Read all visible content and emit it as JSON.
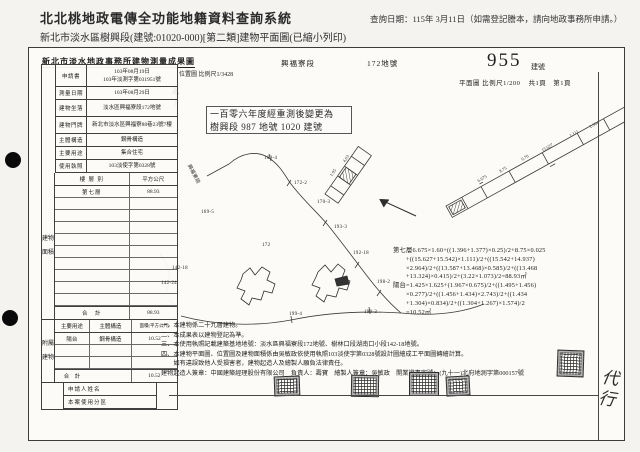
{
  "colors": {
    "paper": "#f3f2ef",
    "box_bg": "#fcfbf8",
    "line": "#3f3f3f",
    "text": "#1c1c1c"
  },
  "page": {
    "app_title": "北北桃地政電傳全功能地籍資料查詢系統",
    "query_date": "查詢日期：115年 3月11日（如需登記謄本，請向地政事務所申請。）",
    "subtitle": "新北市淡水區樹興段(建號:01020-000)[第二類]建物平面圖(已縮小列印)"
  },
  "form": {
    "title": "新北市淡水地政事務所建物測量成果圖",
    "section_name": "興福寮段",
    "parcel_no": "172地號",
    "building_no": "955",
    "building_no_suffix": "建號",
    "location_scale": "位置圖 比例尺1/3428",
    "plan_scale": "平面圖 比例尺1/200",
    "pages": "共1頁　第1頁",
    "callout": [
      "一百零六年度經重測後變更為",
      "樹興段 987 地號 1020 建號"
    ],
    "fields": [
      {
        "label": "申請書",
        "value": "103年08月19日",
        "value2": "103年淡測字第031951號"
      },
      {
        "label": "測量日期",
        "value": "103年08月29日"
      },
      {
        "label": "建物坐落",
        "value": "淡水區興福寮段172地號"
      },
      {
        "label": "建物門牌",
        "value": "新北市淡水區興福寮88巷23號7樓"
      },
      {
        "label": "主體構造",
        "value": "鋼骨構造"
      },
      {
        "label": "主要用途",
        "value": "集合住宅"
      },
      {
        "label": "使用執照",
        "value": "103淡使字第0328號"
      }
    ],
    "area": {
      "vertical_label": "建物面積",
      "h1": "樓 層 別",
      "h2": "平方公尺",
      "rows": [
        {
          "c1": "第七層",
          "c2": "88.93"
        }
      ],
      "total_label": "合　計",
      "total": "88.93"
    },
    "annex": {
      "vertical_label": "附屬建物",
      "h1": "主要用途",
      "h2": "主體構造",
      "h3": "面積(平方公尺)",
      "rows": [
        {
          "c1": "陽台",
          "c2": "鋼骨構造",
          "c3": "10.52"
        }
      ],
      "total_label": "合　計",
      "total": "10.52"
    },
    "bottom": [
      "申請人姓名",
      "本案使用分區"
    ],
    "formula_lines": [
      "第七層6.675×1.60+((1.396+1.377)×0.25)/2+8.75×0.025",
      "　　+((15.627+15.542)×1.111)/2+((15.542+14.937)",
      "　　×2.964)/2+((13.587+13.468)×0.585)/2+((13.468",
      "　　+13.324)×0.415)/2+(3.22×1.073)/2=88.93㎡",
      "陽台=1.425×1.625+(1.967×0.675)/2+((1.495+1.456)",
      "　　×0.277)/2+((1.456+1.434)×2.743)/2+((1.434",
      "　　+1.304)×0.834)/2+((1.304+1.267)×1.574)/2",
      "　　=10.52㎡"
    ],
    "notes": [
      "一、本建物係二十九層建物。",
      "二、本成果表以建物登記為準。",
      "三、本使用執照記載建築基地地號：淡水區興福寮段172地號、樹林口段湖南口小段142-18地號。",
      "四、本建物平面圖、位置圖及建物面積係由吳敏政依使用執照103淡使字第0328號設計圖繪成工平面圖轉繪計算。",
      "　　如有違誤致他人受損害者，建物起造人及繪製人願負法律責任。",
      "建物起造人簽章：中國建築經理股份有限公司　負責人：壽寶　繪製人簽章：吳敏政　開業證書字號：(九十一)北府地測字第000157號"
    ],
    "signature": "代行"
  },
  "map": {
    "parcels": [
      {
        "label": "169-4"
      },
      {
        "label": "172-2"
      },
      {
        "label": "170-3"
      },
      {
        "label": "193-3"
      },
      {
        "label": "192-18"
      },
      {
        "label": "198-2"
      },
      {
        "label": "172"
      },
      {
        "label": "142-18"
      },
      {
        "label": "142-24"
      },
      {
        "label": "199-4"
      },
      {
        "label": "199-3"
      },
      {
        "label": "169-5"
      },
      {
        "label": "興福寮段"
      }
    ],
    "dims": [
      {
        "label": "6.675"
      },
      {
        "label": "8.75"
      },
      {
        "label": "6.70"
      },
      {
        "label": "15.627"
      },
      {
        "label": "1.111"
      },
      {
        "label": "2.964"
      },
      {
        "label": "1.95"
      },
      {
        "label": "4.03"
      }
    ]
  }
}
